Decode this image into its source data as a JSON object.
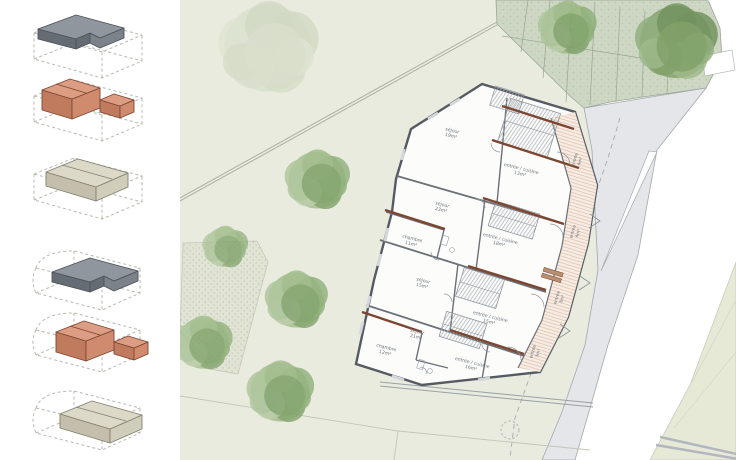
{
  "app": {
    "kind": "architectural site plan presentation"
  },
  "sidebar": {
    "palettes": {
      "gray": {
        "top": "#8f969e",
        "front": "#666c74",
        "side": "#7b828a",
        "outline": "#4d525a"
      },
      "orange": {
        "top": "#dd9d82",
        "front": "#c07a5e",
        "side": "#d08a6e",
        "outline": "#7c4733"
      },
      "beige": {
        "top": "#ddd9c8",
        "front": "#c3bfac",
        "side": "#d1cdbb",
        "outline": "#84816f"
      }
    },
    "diagrams": [
      {
        "name": "massing-diagram-1",
        "variant": "A",
        "shape": "slab",
        "palette": "gray"
      },
      {
        "name": "massing-diagram-2",
        "variant": "A",
        "shape": "block",
        "palette": "orange"
      },
      {
        "name": "massing-diagram-3",
        "variant": "A",
        "shape": "house",
        "palette": "beige"
      },
      {
        "name": "massing-diagram-4",
        "variant": "B",
        "shape": "slab",
        "palette": "gray"
      },
      {
        "name": "massing-diagram-5",
        "variant": "B",
        "shape": "block",
        "palette": "orange"
      },
      {
        "name": "massing-diagram-6",
        "variant": "B",
        "shape": "house",
        "palette": "beige"
      }
    ],
    "tile_tops": [
      5,
      68,
      146,
      238,
      300,
      378
    ]
  },
  "plan": {
    "colors": {
      "ground": "#e9ebdf",
      "green_zone": "#cdd7c3",
      "road": "#e4e6e9",
      "parcel": "#e7e9d7",
      "gravel": "#e1e4d5",
      "wall": "#565b63",
      "beam": "#7d4630",
      "balcony": "#f7ede5",
      "label": "#6d737a",
      "line": "#a2a8ae"
    },
    "green_zone": {
      "stall_lines": [
        [
          348,
          0,
          341,
          52
        ],
        [
          370,
          0,
          363,
          78
        ],
        [
          392,
          0,
          386,
          102
        ],
        [
          415,
          3,
          410,
          105
        ],
        [
          440,
          7,
          436,
          101
        ],
        [
          465,
          11,
          462,
          97
        ],
        [
          490,
          17,
          487,
          93
        ],
        [
          322,
          36,
          524,
          68
        ]
      ]
    },
    "tree_palettes": {
      "green": [
        "#9cba86",
        "#8aad74",
        "#aac398",
        "#7da066",
        "#b7cba6"
      ],
      "faded": [
        "#ccd6bc",
        "#c0cdb0",
        "#d6dec8",
        "#c8d2b6"
      ],
      "dark": [
        "#7fa066",
        "#6f915a",
        "#8fae7c",
        "#9cb888"
      ]
    },
    "trees": [
      {
        "x": 88,
        "y": 48,
        "r": 46,
        "palette": "faded",
        "opacity": 0.55
      },
      {
        "x": 137,
        "y": 180,
        "r": 30,
        "palette": "green",
        "opacity": 0.9
      },
      {
        "x": 116,
        "y": 300,
        "r": 29,
        "palette": "green",
        "opacity": 0.9
      },
      {
        "x": 23,
        "y": 343,
        "r": 27,
        "palette": "green",
        "opacity": 0.85
      },
      {
        "x": 100,
        "y": 392,
        "r": 31,
        "palette": "green",
        "opacity": 0.9
      },
      {
        "x": 45,
        "y": 247,
        "r": 21,
        "palette": "green",
        "opacity": 0.8
      },
      {
        "x": 387,
        "y": 28,
        "r": 27,
        "palette": "green",
        "opacity": 0.9
      },
      {
        "x": 496,
        "y": 42,
        "r": 38,
        "palette": "dark",
        "opacity": 0.95
      }
    ],
    "building": {
      "rooms": [
        {
          "name": "sejour-1",
          "label": "séjour",
          "area": "19m²",
          "x": 272,
          "y": 132,
          "rot": 14
        },
        {
          "name": "entree-cuisine-1",
          "label": "entrée / cuisine",
          "area": "13m²",
          "x": 341,
          "y": 170,
          "rot": 14
        },
        {
          "name": "sejour-2",
          "label": "séjour",
          "area": "23m²",
          "x": 262,
          "y": 206,
          "rot": 14
        },
        {
          "name": "chambre-2",
          "label": "chambre",
          "area": "11m²",
          "x": 232,
          "y": 240,
          "rot": 14
        },
        {
          "name": "entree-cuisine-2",
          "label": "entrée / cuisine",
          "area": "18m²",
          "x": 320,
          "y": 240,
          "rot": 14
        },
        {
          "name": "sejour-3",
          "label": "séjour",
          "area": "15m²",
          "x": 243,
          "y": 282,
          "rot": 14
        },
        {
          "name": "entree-cuisine-3",
          "label": "entrée / cuisine",
          "area": "15m²",
          "x": 310,
          "y": 318,
          "rot": 14
        },
        {
          "name": "sejour-4",
          "label": "séjour",
          "area": "21m²",
          "x": 237,
          "y": 333,
          "rot": 14
        },
        {
          "name": "chambre-4",
          "label": "chambre",
          "area": "12m²",
          "x": 206,
          "y": 349,
          "rot": 14
        },
        {
          "name": "entree-cuisine-4",
          "label": "entrée / cuisine",
          "area": "16m²",
          "x": 292,
          "y": 364,
          "rot": 14
        }
      ],
      "strip_rooms": [
        {
          "name": "entree-a",
          "label": "entrée",
          "area": "4m²",
          "x": 396,
          "y": 160,
          "rot": -73
        },
        {
          "name": "entree-b",
          "label": "entrée",
          "area": "4m²",
          "x": 394,
          "y": 232,
          "rot": -73
        },
        {
          "name": "entree-c",
          "label": "entrée",
          "area": "3m²",
          "x": 378,
          "y": 298,
          "rot": -73
        },
        {
          "name": "entree-d",
          "label": "entrée",
          "area": "3m²",
          "x": 354,
          "y": 352,
          "rot": -73
        }
      ]
    }
  }
}
